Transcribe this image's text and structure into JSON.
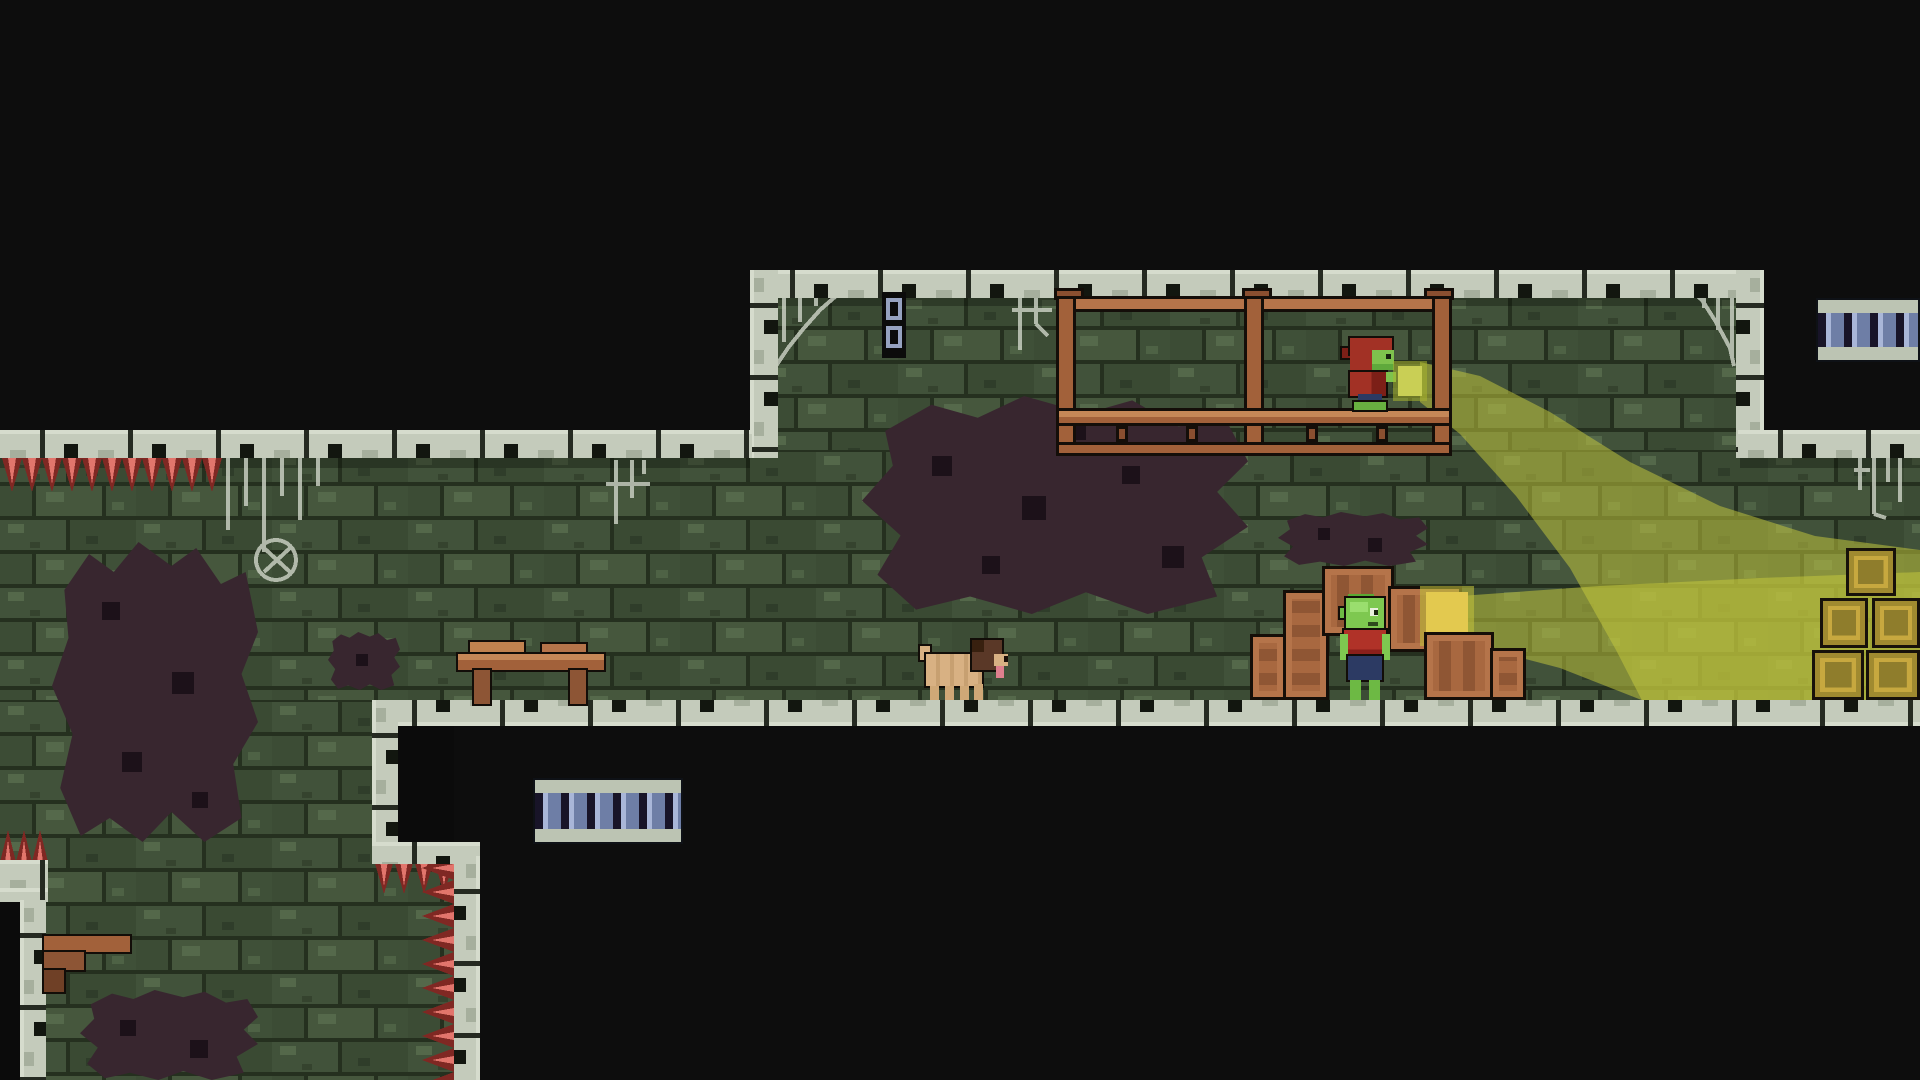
{
  "app": {
    "type": "pixel-art platformer game screenshot",
    "view": "dungeon cave level with three connected chambers"
  },
  "palette": {
    "background": "#0d0d0d",
    "brick": "#41523a",
    "brick_dark": "#3a4a33",
    "brick_light": "#55694b",
    "mortar": "#25301f",
    "stone_border": "#c4cbbb",
    "stone_shadow": "#a6af9d",
    "wood_light": "#b5744a",
    "wood": "#a2613a",
    "wood_dark": "#8a4f30",
    "goblin_skin": "#7ec850",
    "cloth_red": "#a23125",
    "shirt_red": "#b03228",
    "cloth_blue": "#2c3a63",
    "beam_yellow": "#c5ca3e",
    "gold": "#c7a83f",
    "spike_red": "#7f2823",
    "spike_pink": "#e2756c",
    "web_gray": "#cfd5c8",
    "stain_purple": "#38262f",
    "dog_tan": "#d8b183",
    "dog_brown": "#5a3827",
    "tongue_pink": "#df7f8e",
    "platform_blue": "#6e7ea6",
    "chain_blue": "#96a2c0"
  },
  "rooms": [
    {
      "name": "upper-alcove",
      "feature": "wooden walkway scaffold"
    },
    {
      "name": "main-hall",
      "feature": "full-width chamber with floor ledge"
    },
    {
      "name": "lower-left-chamber",
      "feature": "spiked shaft with broken shelf"
    }
  ],
  "characters": [
    {
      "id": "hooded-goblin",
      "description": "goblin in red hood on wooden walkway holding glowing lantern that casts a diagonal light beam"
    },
    {
      "id": "goblin-villager",
      "description": "goblin in red shirt and blue pants standing among crates beside a glowing gold pile casting a horizontal light beam"
    },
    {
      "id": "dog",
      "description": "small tan pug-like dog facing right on the main hall floor"
    }
  ],
  "props": {
    "walkway_posts": 3,
    "crates": 6,
    "gold_blocks": 5,
    "light_beams": 2,
    "glowing_lanterns": 2,
    "ladder_platforms": 2,
    "hanging_chain_links": 2,
    "tables": 1,
    "broken_shelves": 1,
    "cobwebs": 6,
    "spike_strips": 4,
    "dark_stains": 5
  }
}
